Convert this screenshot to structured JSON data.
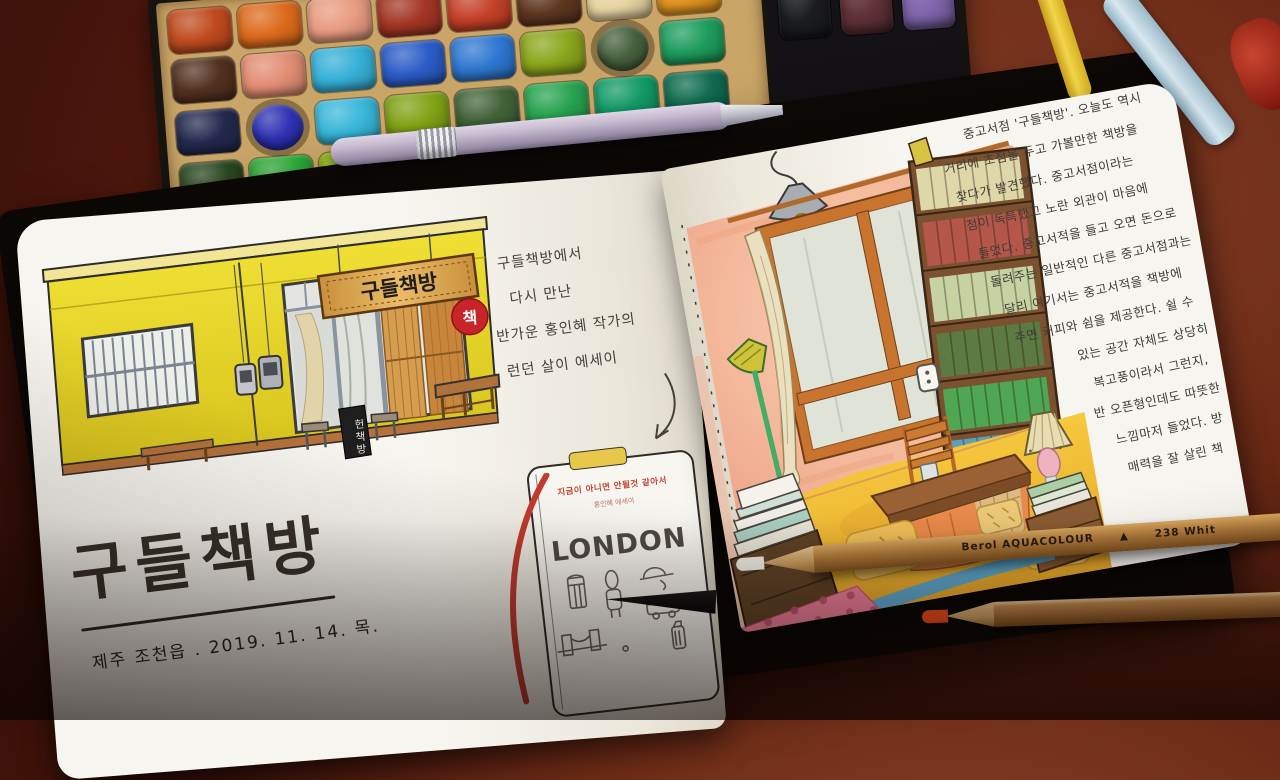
{
  "scene": {
    "description": "Hand-painted watercolor journal spread about the secondhand bookstore Gudeul Chaekbang, lying open on a dark red wooden desk with a watercolor palette, a pen and pencils"
  },
  "palette": {
    "rows": [
      [
        "#bf4a1e",
        "#dd6a1c",
        "#e89b80",
        "#a33524",
        "#c44027",
        "#5e3620",
        "#e7d4a2",
        "#e0931f"
      ],
      [
        "#52301f",
        "#e28d73",
        "#35b0d6",
        "#2b5cc6",
        "#2e77d0",
        "#8aa61c",
        "#44603c",
        "#1d9c5c"
      ],
      [
        "#23294e",
        "#2e31b2",
        "#38b7d9",
        "#7fa315",
        "#42633a",
        "#28a350",
        "#129a66",
        "#0f6b50"
      ],
      [
        "#2a4a21",
        "#2fae3a",
        "#93bc10",
        "#5ec52a",
        "#3bb164",
        "#1f8e55",
        "#156b4a",
        "#11463a"
      ]
    ],
    "black_tray": [
      "#1b1c20",
      "#5f3138",
      "#8066ae"
    ]
  },
  "left_page": {
    "storefront": {
      "sign_text": "구들책방",
      "badge_text": "책",
      "standing_sign_text": "헌책방"
    },
    "note_lines": [
      "구들책방에서",
      "다시 만난",
      "반가운 홍인혜 작가의",
      "런던 살이 에세이"
    ],
    "book_cover": {
      "title": "지금이 아니면 안될것 같아서",
      "author_line": "홍인혜 에세이",
      "big_text": "LONDON"
    },
    "title_calligraphy": "구들책방",
    "date_caption": "제주 조천읍 . 2019. 11. 14. 목."
  },
  "right_page": {
    "journal_lines": [
      "중고서점 '구들책방'. 오늘도 역시",
      "거리에 초점을 두고 가볼만한 책방을",
      "찾다가 발견했다. 중고서점이라는",
      "점이 독특했고 노란 외관이 마음에",
      "들었다. 중고서적을 들고 오면 돈으로",
      "돌려주는 일반적인 다른 중고서점과는",
      "달리 여기서는 중고서적을 책방에",
      "주면 커피와 쉼을 제공한다. 쉴 수",
      "있는 공간 자체도 상당히",
      "복고풍이라서 그런지,",
      "반 오픈형인데도 따뜻한",
      "느낌마저 들었다. 방",
      "매력을 잘 살린 책"
    ],
    "bookshelf_colors": [
      "#ded8a8",
      "#b4574a",
      "#c6d2a2",
      "#5d7a42",
      "#4fa653",
      "#5f9fb8"
    ]
  },
  "pencils": {
    "brand_label": "Berol AQUACOLOUR",
    "logo_glyph": "▲",
    "code_label": "238 Whit"
  }
}
